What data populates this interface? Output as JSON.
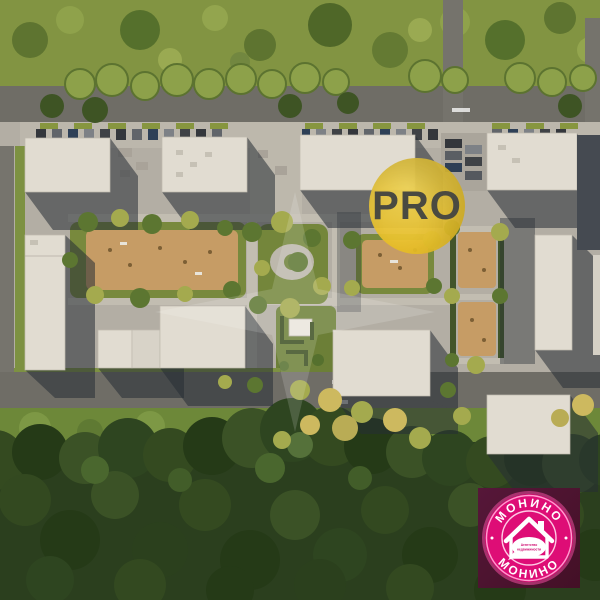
{
  "pro_badge": {
    "label": "PRO"
  },
  "logo": {
    "brand_top": "МОНИНО",
    "brand_bottom": "МОНИНО",
    "tagline_line1": "Агентство",
    "tagline_line2": "недвижимости",
    "icon": "house-icon"
  },
  "watermark": {
    "icon": "four-point-star-watermark"
  },
  "colors": {
    "pro_circle": "#ecc634",
    "pro_text": "#4a4a41",
    "logo_magenta": "#de0d76",
    "logo_ring": "#ffb8dc",
    "logo_bg": "#4e1331",
    "roof": "#e1dcd1",
    "playground_tan": "#c69c65",
    "forest_green": "#2b3f1e",
    "road_gray": "#6f6d66"
  }
}
